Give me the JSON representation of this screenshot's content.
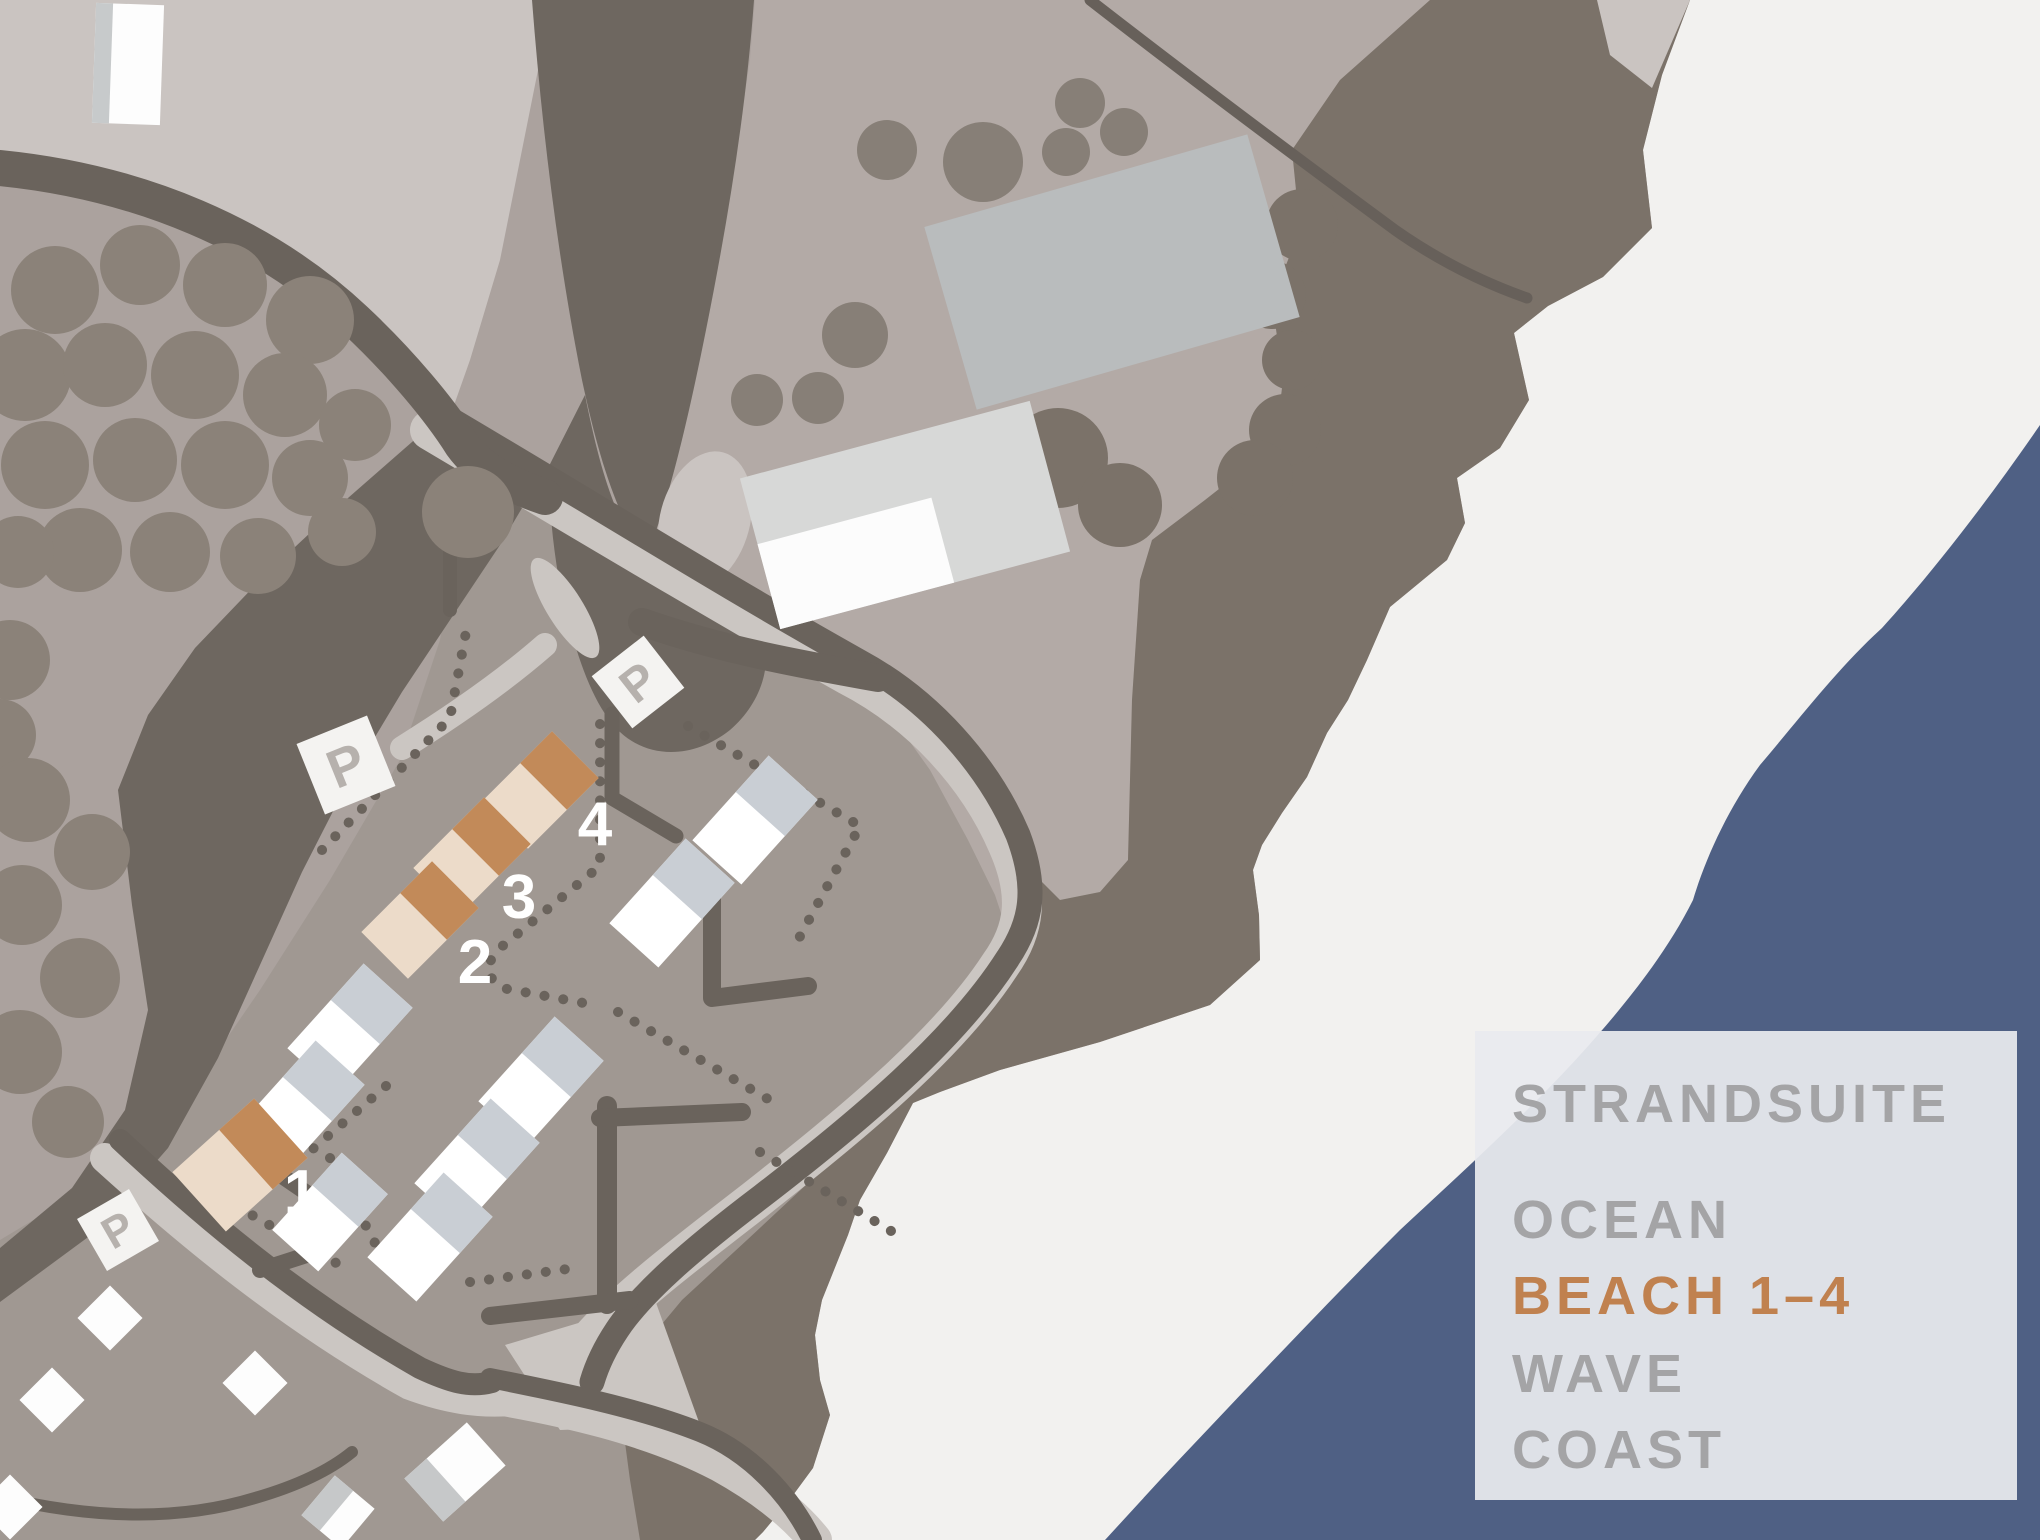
{
  "legend": {
    "lines": [
      {
        "text": "STRANDSUITE",
        "color": "#a4a4a6"
      },
      {
        "text": "OCEAN",
        "color": "#a4a4a6"
      },
      {
        "text": "BEACH 1–4",
        "color": "#c0814f"
      },
      {
        "text": "WAVE",
        "color": "#a4a4a6"
      },
      {
        "text": "COAST",
        "color": "#a4a4a6"
      }
    ]
  },
  "markers": {
    "parking_label": "P",
    "unit_labels": [
      "1",
      "2",
      "3",
      "4"
    ]
  },
  "colors": {
    "sand": "#f2f1ef",
    "water": "#4f6084",
    "headland": "#7b7269",
    "land_light": "#cac4c1",
    "land_mid": "#b3aaa6",
    "land_beige": "#aba29e",
    "land_parcels": "#a09892",
    "road_dark": "#6a635c",
    "grove_dark": "#6e6760",
    "road_light": "#cbc6c2",
    "tree": "#8b8279",
    "roof_accent": "#c28a59",
    "roof_cream": "#ecdbc9",
    "house_white": "#ffffff",
    "house_grey": "#c9ced4",
    "building_grey": "#b9bcbd",
    "building_pale": "#d7d8d7",
    "sign_bg": "#f4f3f1",
    "legend_panel": "#e9ebef"
  }
}
